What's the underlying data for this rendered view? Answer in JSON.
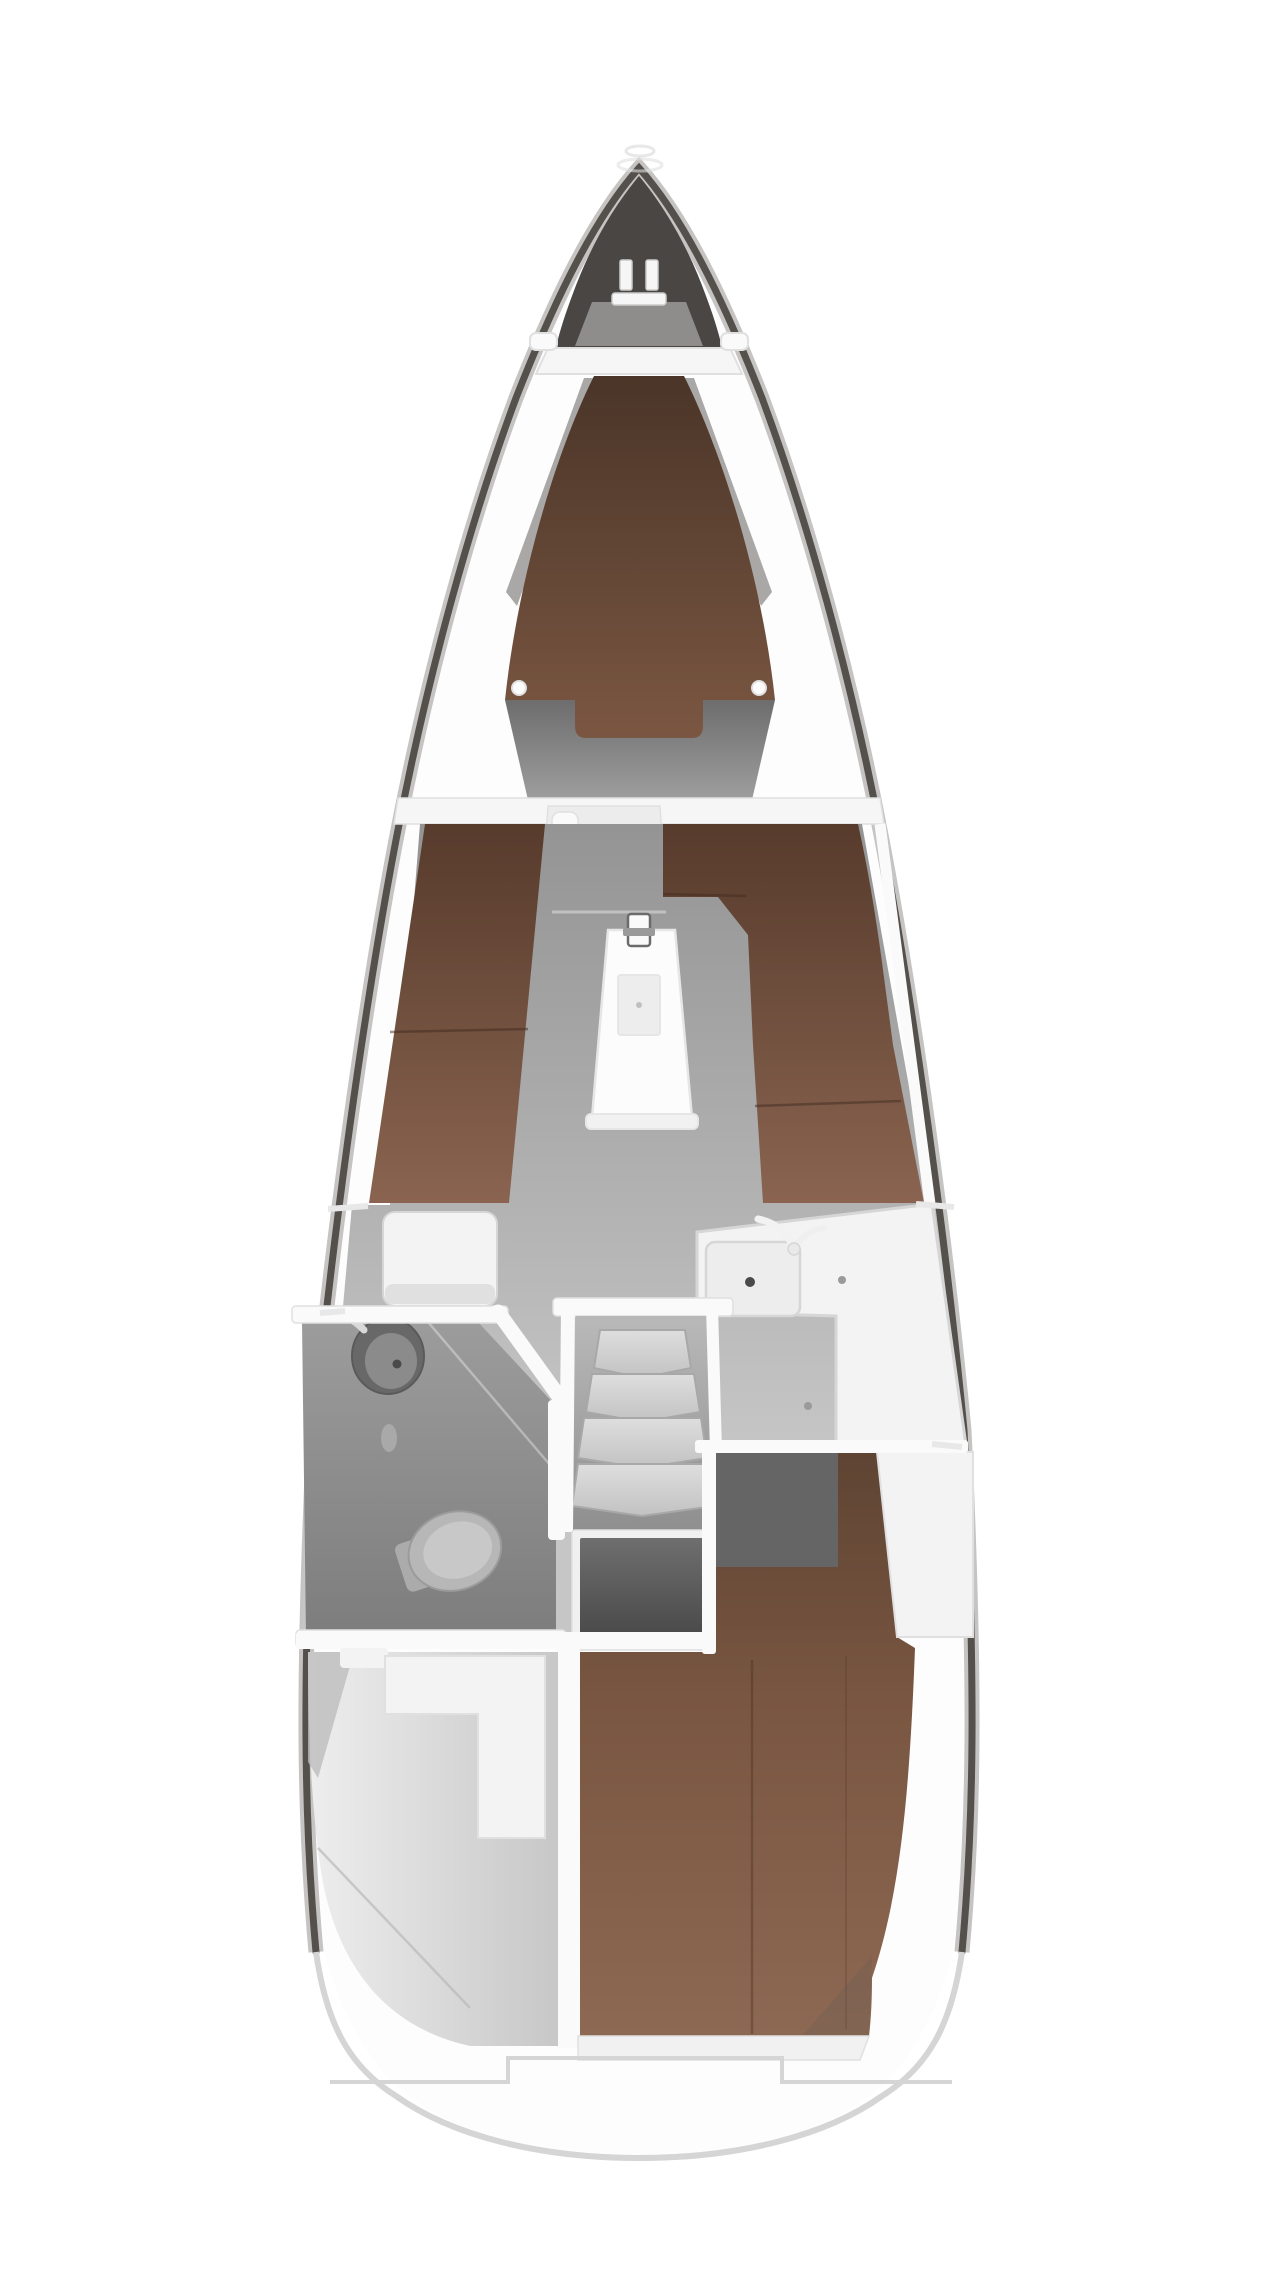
{
  "figure": {
    "type": "sailing-yacht interior floor plan",
    "view": "top-down, bow pointing up",
    "visible_text": "none",
    "areas": [
      {
        "id": "anchor-locker",
        "label": "Bow anchor locker with windlass"
      },
      {
        "id": "foredeck",
        "label": "Foredeck band with two cleats"
      },
      {
        "id": "forward-cabin",
        "label": "Forward cabin V-berth (brown upholstery)"
      },
      {
        "id": "forward-bulkhead",
        "label": "Bulkhead with doorway between V-berth and saloon"
      },
      {
        "id": "saloon",
        "label": "Saloon: port straight settee, starboard L-shaped settee, centre table with mast post"
      },
      {
        "id": "nav-seat",
        "label": "White seat/locker aft of port settee"
      },
      {
        "id": "galley",
        "label": "Starboard L-shaped galley with sink, tap and drain"
      },
      {
        "id": "head",
        "label": "Port wet head with round washbasin and toilet"
      },
      {
        "id": "companionway",
        "label": "Companionway with four steps"
      },
      {
        "id": "engine",
        "label": "Engine compartment under the steps"
      },
      {
        "id": "aft-cabin",
        "label": "Aft double cabin: brown berth, entry corridor, white wardrobe"
      },
      {
        "id": "cockpit-locker",
        "label": "Port aft stowage / cockpit locker"
      },
      {
        "id": "stern",
        "label": "Rounded stern with stepped swim ledge"
      }
    ]
  },
  "palette": {
    "page_bg": "#ffffff",
    "hull_fill": "#fdfdfd",
    "hull_line": "#54504c",
    "hull_shade": "#c6c4c2",
    "stern_edge": "#d5d5d5",
    "bow_dark": "#494644",
    "bow_lid": "#8f8d8b",
    "deck_band": "#f6f6f6",
    "band_edge": "#e0e0e0",
    "wall_white": "#fafafa",
    "fitting_white": "#f6f6f6",
    "fitting_edge": "#cccccc",
    "v_top": "#4a3528",
    "v_bot": "#7b5742",
    "wedge_gray": "#8d8b89",
    "window_dot": "#fdfdfd",
    "settee_top": "#573b2c",
    "settee_bot": "#8a6450",
    "seam_brown": "#3f2c20",
    "aft_top": "#5f4433",
    "aft_mid": "#7a5742",
    "aft_bot": "#8d6852",
    "floor_top": "#949494",
    "floor_bot": "#c6c6c6",
    "forepeak_top": "#6d6d6d",
    "forepeak_bot": "#9e9e9e",
    "corridor": "#656565",
    "head_top": "#9c9c9c",
    "head_bot": "#7d7d7d",
    "steps_bg_top": "#b8b8b8",
    "steps_bg_bot": "#8f8f8f",
    "tread_light": "#dedede",
    "tread_dark": "#c2c2c2",
    "tread_edge": "#a8a8a8",
    "engine_top": "#6e6e6e",
    "engine_bot": "#454545",
    "counter": "#f3f3f3",
    "counter_edge": "#d6d6d6",
    "sink_basin": "#ededed",
    "drain": "#4a4a4a",
    "table_white": "#fcfcfc",
    "table_edge": "#e6e6e6",
    "leaf_fill": "#ededed",
    "post_edge": "#6b6b6b",
    "beam_gray": "#c0c0c0",
    "head_sink_outer": "#686868",
    "head_sink_inner": "#8b8b8b",
    "toilet_body": "#b7b7b7",
    "toilet_seat": "#c8c8c8",
    "toilet_edge": "#9b9b9b",
    "locker_light": "#efefef",
    "locker_dark": "#c7c7c7",
    "deck_line": "#e8e8e8",
    "shadow_brown": "#6b5d54"
  }
}
